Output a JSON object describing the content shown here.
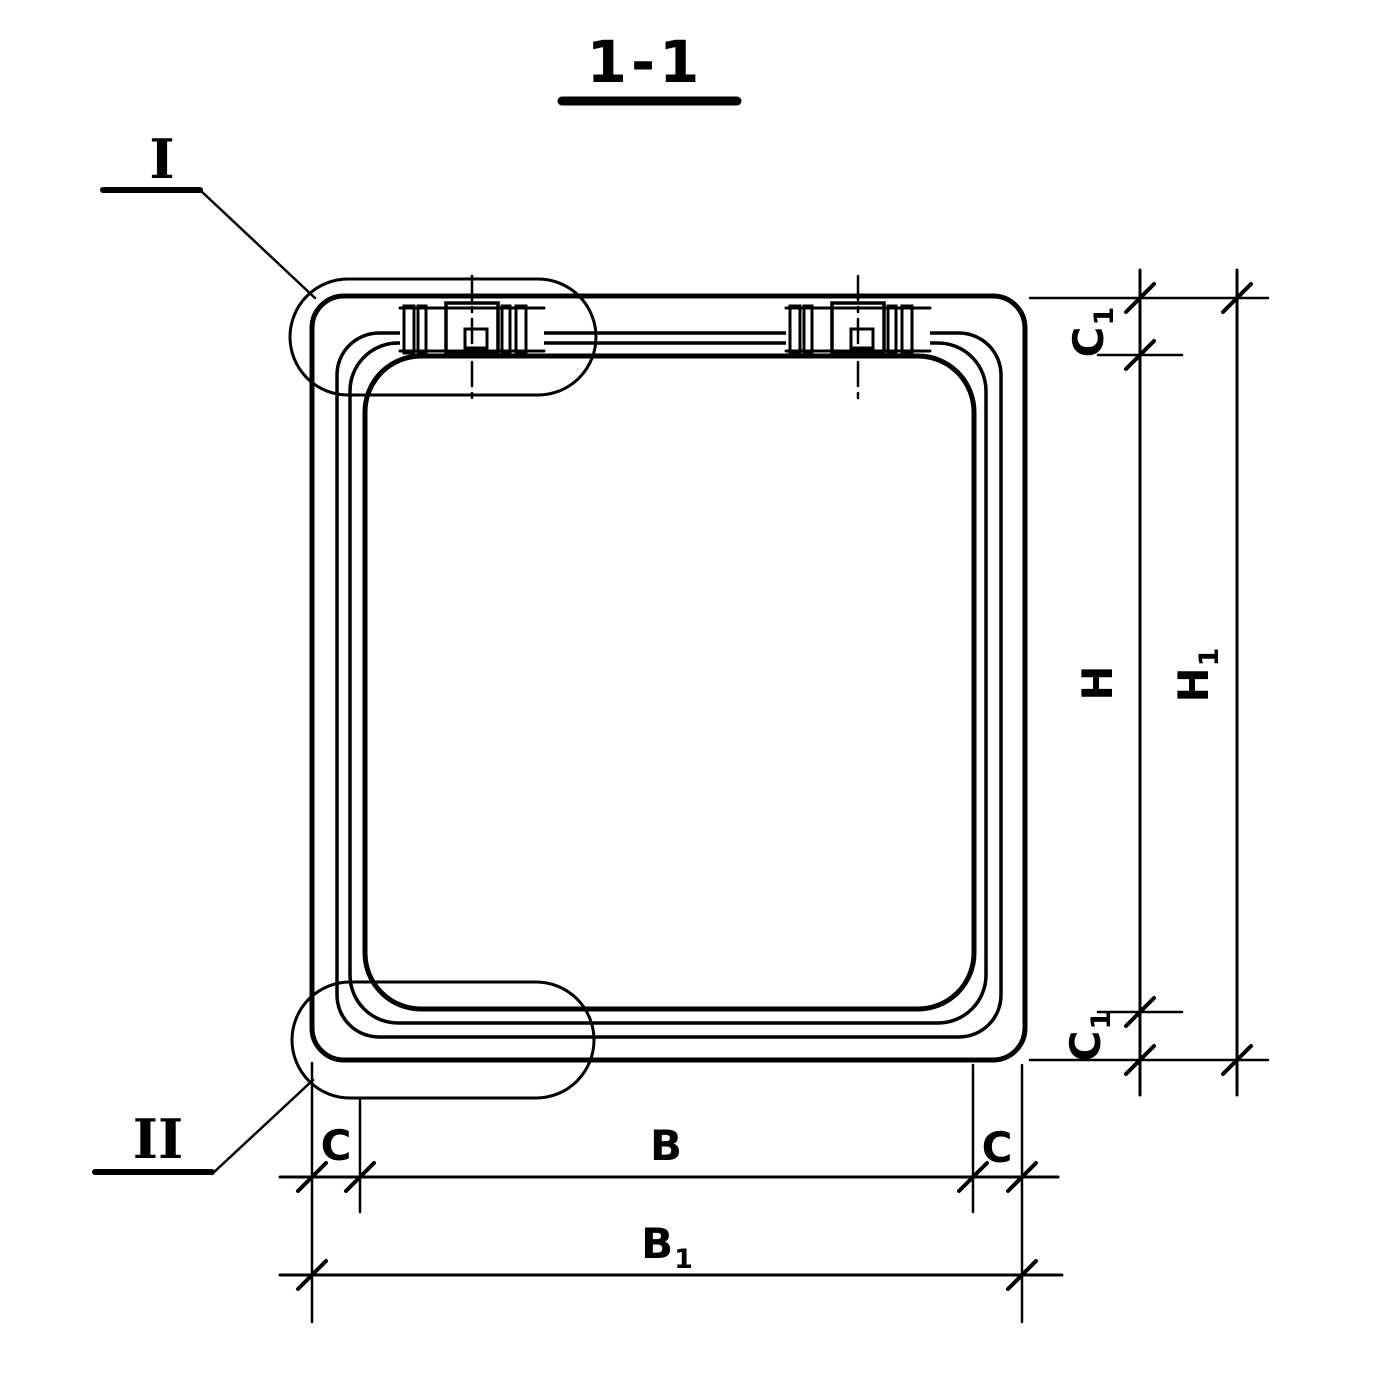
{
  "drawing": {
    "title": "1-1",
    "ink_color": "#000000",
    "background_color": "#ffffff"
  },
  "details": {
    "detail_top_left": {
      "label": "I"
    },
    "detail_bottom_left": {
      "label": "II"
    }
  },
  "dimensions": {
    "c1_top": {
      "base": "C",
      "sub": "1"
    },
    "h": {
      "base": "H",
      "sub": ""
    },
    "h1": {
      "base": "H",
      "sub": "1"
    },
    "c1_bottom": {
      "base": "C",
      "sub": "1"
    },
    "c_bottom_left": {
      "base": "C",
      "sub": ""
    },
    "b": {
      "base": "B",
      "sub": ""
    },
    "c_bottom_right": {
      "base": "C",
      "sub": ""
    },
    "b1": {
      "base": "B",
      "sub": "1"
    }
  }
}
